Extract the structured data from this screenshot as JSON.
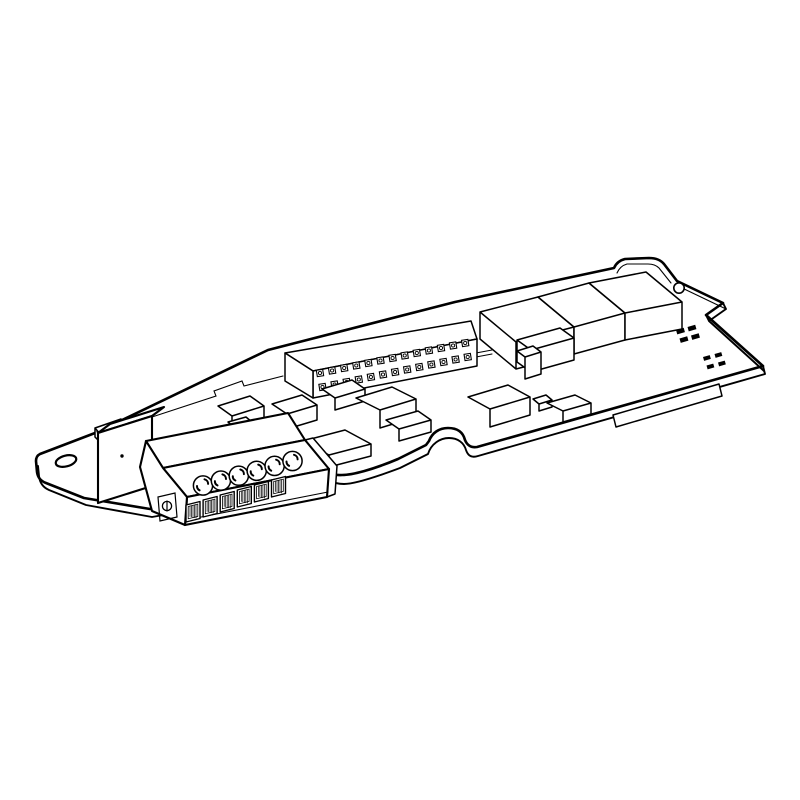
{
  "page": {
    "background_color": "#ffffff",
    "line_color": "#000000",
    "title": "Line illustration of an electronic option card (PCB) with pluggable screw terminal block"
  },
  "illustration": {
    "description": "Isometric black-and-white technical drawing of a printed circuit board viewed from the upper left. A mounting tab with a hole is at the left end, followed by a relay component and a 6-pole screw terminal block overhanging the front edge. A dual-row pin header runs along the middle of the board, a row of three large rectangular components sits along the upper right edge, assorted small rectangular components populate the center, tiny solder marks are printed near the right end, and an edge-connector tab protrudes from the lower right edge.",
    "components": {
      "mounting_tab": {
        "name": "mounting-tab",
        "hole_count": 1
      },
      "relay": {
        "name": "relay-component",
        "dot_count": 1
      },
      "terminal_block": {
        "name": "screw-terminal-block",
        "screw_count": 6,
        "wire_opening_count": 6,
        "side_screw_count": 1
      },
      "pin_header": {
        "name": "dual-row-pin-header",
        "rows": 2,
        "pins_per_row": 13
      },
      "large_component_row": {
        "name": "large-component-row",
        "count": 3
      },
      "small_components": {
        "name": "small-components",
        "count": 12
      },
      "solder_marks": {
        "name": "solder-marks",
        "clusters": 2,
        "marks_per_cluster": 4
      },
      "edge_connector": {
        "name": "edge-connector-tab",
        "count": 1
      }
    }
  }
}
